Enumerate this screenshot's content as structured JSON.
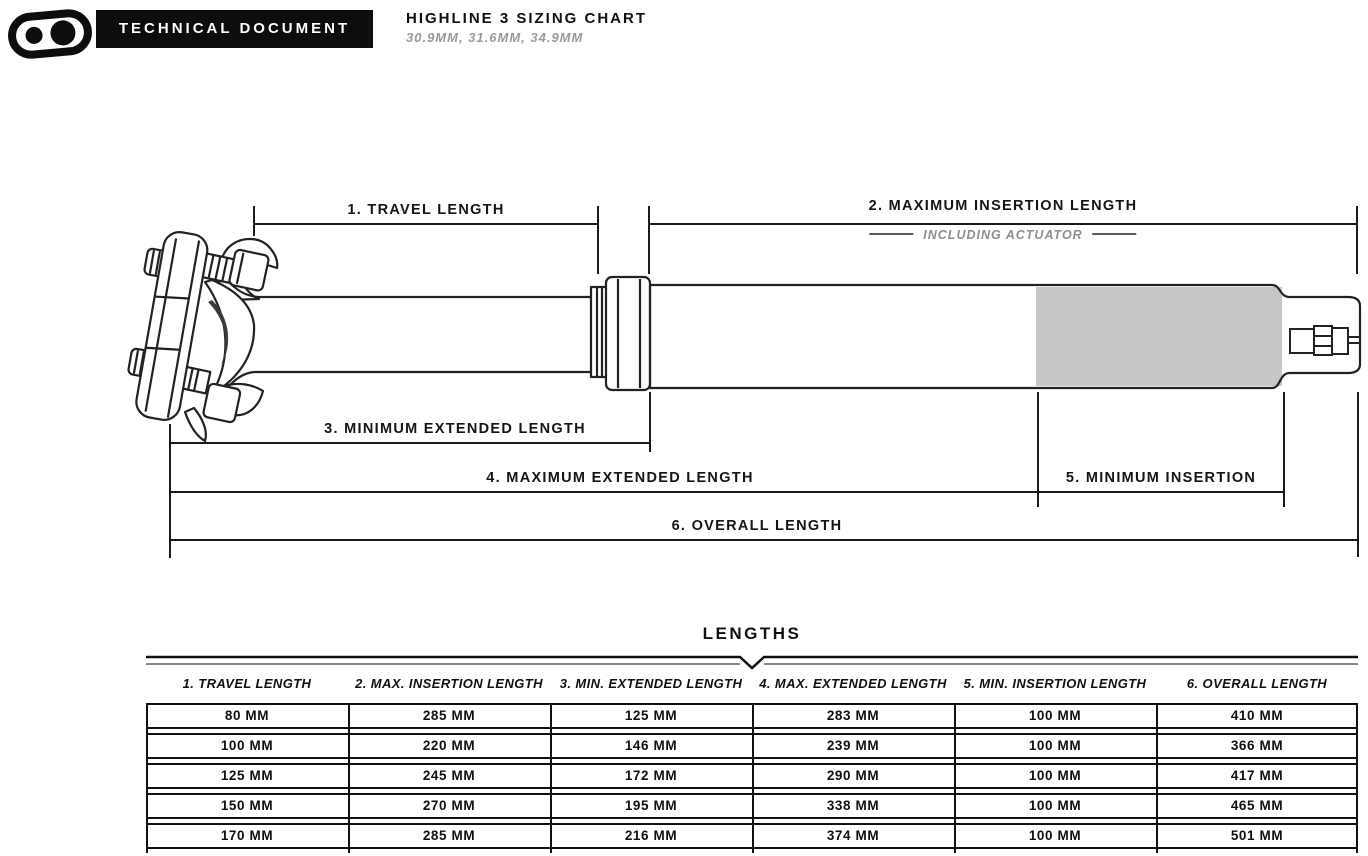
{
  "header": {
    "logo": "crankbrothers-logo",
    "badge": "TECHNICAL DOCUMENT",
    "title": "HIGHLINE 3 SIZING CHART",
    "subtitle": "30.9MM, 31.6MM, 34.9MM"
  },
  "diagram": {
    "labels": {
      "travel": "1. TRAVEL LENGTH",
      "max_insertion": "2. MAXIMUM INSERTION LENGTH",
      "including_actuator": "INCLUDING ACTUATOR",
      "min_extended": "3. MINIMUM EXTENDED LENGTH",
      "max_extended": "4. MAXIMUM EXTENDED LENGTH",
      "min_insertion": "5. MINIMUM INSERTION",
      "overall": "6. OVERALL LENGTH"
    },
    "colors": {
      "line": "#1a1a1a",
      "insertion_zone_fill": "#c6c6c6",
      "muted_text": "#8e8e8e"
    }
  },
  "table": {
    "title": "LENGTHS",
    "columns": [
      "1. TRAVEL LENGTH",
      "2. MAX. INSERTION LENGTH",
      "3. MIN. EXTENDED LENGTH",
      "4. MAX. EXTENDED LENGTH",
      "5. MIN. INSERTION LENGTH",
      "6. OVERALL LENGTH"
    ],
    "rows": [
      [
        "80 MM",
        "285 MM",
        "125 MM",
        "283 MM",
        "100 MM",
        "410 MM"
      ],
      [
        "100 MM",
        "220 MM",
        "146 MM",
        "239 MM",
        "100 MM",
        "366 MM"
      ],
      [
        "125 MM",
        "245 MM",
        "172 MM",
        "290 MM",
        "100 MM",
        "417 MM"
      ],
      [
        "150 MM",
        "270 MM",
        "195 MM",
        "338 MM",
        "100 MM",
        "465 MM"
      ],
      [
        "170 MM",
        "285 MM",
        "216 MM",
        "374 MM",
        "100 MM",
        "501 MM"
      ]
    ]
  },
  "chart_data": {
    "type": "table",
    "title": "LENGTHS",
    "columns": [
      "1. TRAVEL LENGTH",
      "2. MAX. INSERTION LENGTH",
      "3. MIN. EXTENDED LENGTH",
      "4. MAX. EXTENDED LENGTH",
      "5. MIN. INSERTION LENGTH",
      "6. OVERALL LENGTH"
    ],
    "rows_mm": [
      [
        80,
        285,
        125,
        283,
        100,
        410
      ],
      [
        100,
        220,
        146,
        239,
        100,
        366
      ],
      [
        125,
        245,
        172,
        290,
        100,
        417
      ],
      [
        150,
        270,
        195,
        338,
        100,
        465
      ],
      [
        170,
        285,
        216,
        374,
        100,
        501
      ]
    ]
  }
}
